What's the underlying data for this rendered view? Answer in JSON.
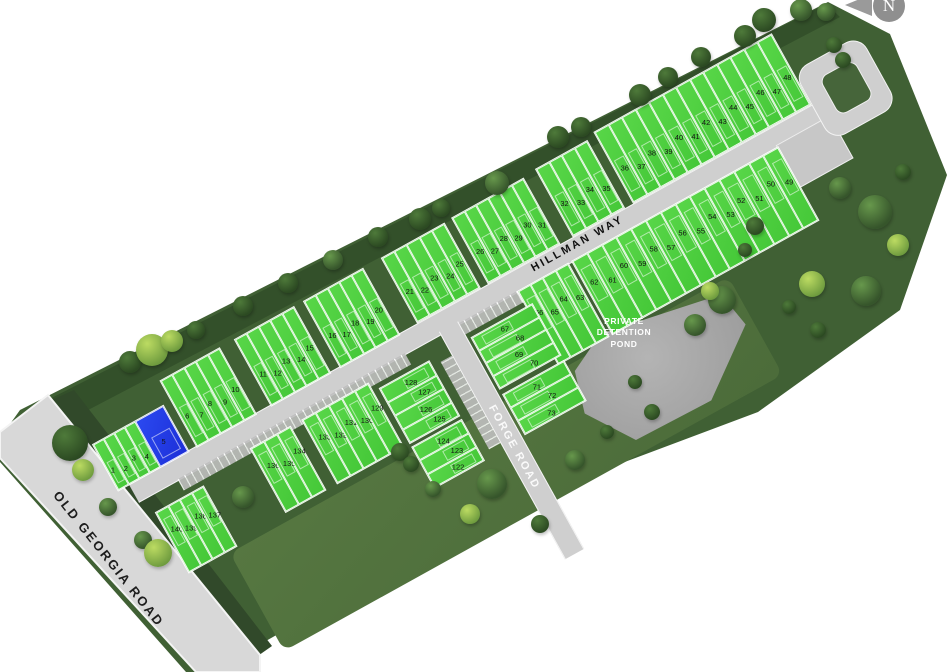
{
  "map": {
    "north_label": "N",
    "pond_label": "PRIVATE\nDETENTION\nPOND",
    "roads": {
      "old_georgia": "OLD GEORGIA ROAD",
      "hillman": "HILLMAN WAY",
      "forge": "FORGE ROAD"
    },
    "highlighted_lot": "5",
    "colors": {
      "lot_green": "#4ecb3f",
      "highlight_blue": "#2038e8",
      "road_gray": "#cfcfcf",
      "pond_gray": "#ababab",
      "parcel_green": "#406034"
    }
  },
  "lot_blocks": [
    {
      "id": "block-1-5",
      "numbers": [
        "1",
        "2",
        "3",
        "4",
        "5"
      ],
      "highlighted": "5"
    },
    {
      "id": "block-6-10",
      "numbers": [
        "6",
        "7",
        "8",
        "9",
        "10"
      ]
    },
    {
      "id": "block-11-15",
      "numbers": [
        "11",
        "12",
        "13",
        "14",
        "15"
      ]
    },
    {
      "id": "block-16-20",
      "numbers": [
        "16",
        "17",
        "18",
        "19",
        "20"
      ]
    },
    {
      "id": "block-21-25",
      "numbers": [
        "21",
        "22",
        "23",
        "24",
        "25"
      ]
    },
    {
      "id": "block-26-31",
      "numbers": [
        "26",
        "27",
        "28",
        "29",
        "30",
        "31"
      ]
    },
    {
      "id": "block-32-35",
      "numbers": [
        "32",
        "33",
        "34",
        "35"
      ]
    },
    {
      "id": "block-36-48",
      "numbers": [
        "36",
        "37",
        "38",
        "39",
        "40",
        "41",
        "42",
        "43",
        "44",
        "45",
        "46",
        "47",
        "48"
      ]
    },
    {
      "id": "block-49-62",
      "numbers": [
        "62",
        "61",
        "60",
        "59",
        "58",
        "57",
        "56",
        "55",
        "54",
        "53",
        "52",
        "51",
        "50",
        "49"
      ]
    },
    {
      "id": "block-63-66",
      "numbers": [
        "66",
        "65",
        "64",
        "63"
      ]
    },
    {
      "id": "block-67-70",
      "numbers": [
        "67",
        "68",
        "69",
        "70"
      ]
    },
    {
      "id": "block-71-73",
      "numbers": [
        "71",
        "72",
        "73"
      ]
    },
    {
      "id": "block-125-128",
      "numbers": [
        "128",
        "127",
        "126",
        "125"
      ]
    },
    {
      "id": "block-122-124",
      "numbers": [
        "124",
        "123",
        "122"
      ]
    },
    {
      "id": "block-129-133",
      "numbers": [
        "133",
        "132",
        "131",
        "130",
        "129"
      ]
    },
    {
      "id": "block-134-136",
      "numbers": [
        "136",
        "135",
        "134"
      ]
    },
    {
      "id": "block-137-140",
      "numbers": [
        "140",
        "139",
        "138",
        "137"
      ]
    }
  ]
}
